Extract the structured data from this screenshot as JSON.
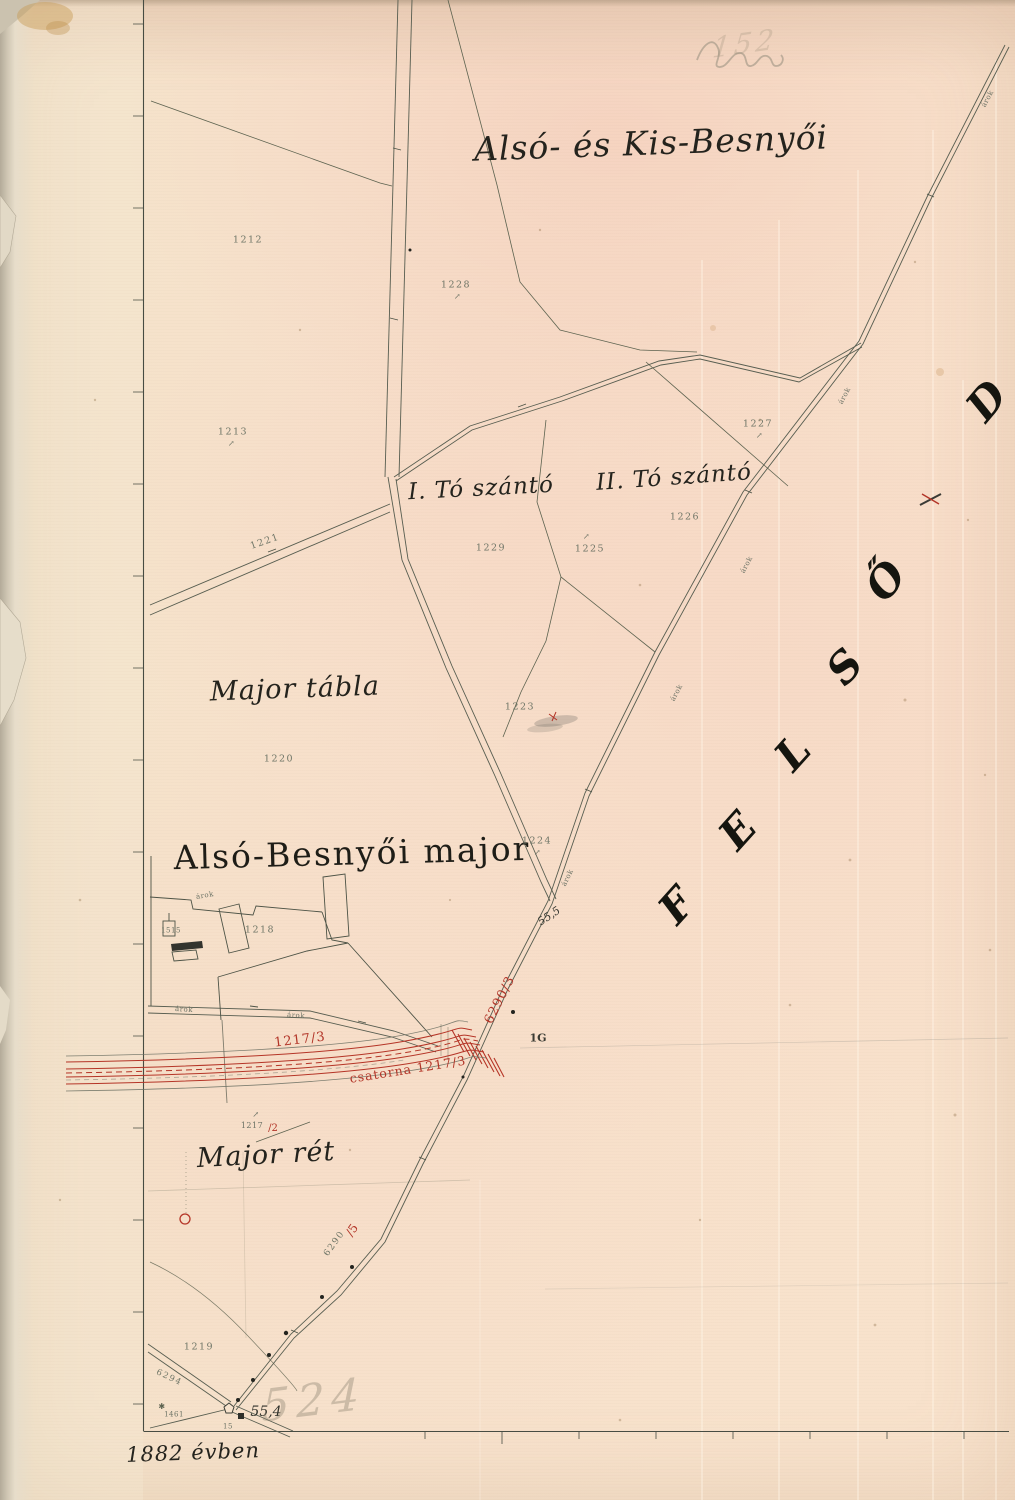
{
  "map": {
    "region_title": "Alsó- és Kis-Besnyői",
    "farm_title": "Alsó-Besnyői major",
    "field_1": "I. Tó szántó",
    "field_2": "II. Tó szántó",
    "major_table": "Major tábla",
    "meadow": "Major rét",
    "year_note": "1882 évben",
    "adjacent_letters": {
      "l1": "F",
      "l2": "E",
      "l3": "L",
      "l4": "S",
      "l5": "Ő",
      "partial": "D"
    }
  },
  "parcels": {
    "p1212": "1212",
    "p1228": "1228",
    "p1213": "1213",
    "p1227": "1227",
    "p1226": "1226",
    "p1229": "1229",
    "p1225": "1225",
    "p1223": "1223",
    "p1220": "1220",
    "p1224": "1224",
    "p1218": "1218",
    "p1515": "1515",
    "p1219": "1219",
    "p1461": "1461",
    "p1221": "1221",
    "p1217": "1217"
  },
  "measurements": {
    "m55_5": "55,5",
    "m55_4": "55,4",
    "m15": "15",
    "marker_1g": "1G",
    "r6294": "6294",
    "r6290": "6290"
  },
  "red_ink": {
    "upper_parcel": "1217/3",
    "channel_label": "csatorna 1217/3",
    "road_parcel": "6290/3",
    "slash5": "/5",
    "slash2": "/2"
  },
  "road_notes": {
    "arok": "árok"
  },
  "pencil": {
    "top_scribble": "152",
    "bottom_number": "524"
  },
  "symbols": {
    "meadow_mark": "↗",
    "star_mark": "✱"
  }
}
